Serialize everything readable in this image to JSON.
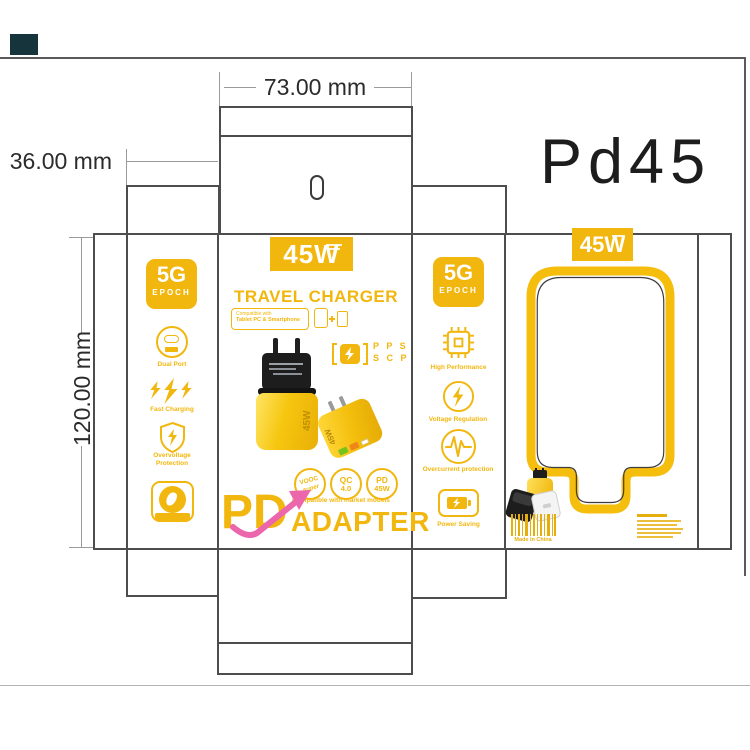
{
  "window": {
    "product_code": "Pd45"
  },
  "dimensions": {
    "width_label": "73.00 mm",
    "depth_label": "36.00 mm",
    "height_label": "120.00 mm"
  },
  "front": {
    "power_badge": "45W",
    "title": "TRAVEL CHARGER",
    "compat_line1": "Compatible with",
    "compat_line2": "Tablet PC & Smartphone",
    "pps_line1": "P P S",
    "pps_line2": "S C P",
    "eu_charger_label": "45W",
    "us_charger_label": "45W",
    "badge1_line1": "VOOC",
    "badge1_line2": "super",
    "badge2_line1": "QC",
    "badge2_line2": "4.0",
    "badge3_line1": "PD",
    "badge3_line2": "45W",
    "brand_pd": "PD",
    "brand_adapter": "ADAPTER",
    "brand_tagline": "Compatible with market models"
  },
  "left_side": {
    "badge_top": "5G",
    "badge_bottom": "EPOCH",
    "features": [
      {
        "icon": "dual-port-icon",
        "label": "Dual Port"
      },
      {
        "icon": "fast-charging-icon",
        "label": "Fast Charging"
      },
      {
        "icon": "overvoltage-shield-icon",
        "label": "Overvoltage Protection"
      },
      {
        "icon": "original-seal-icon",
        "label": "ORIGINAL"
      }
    ]
  },
  "right_side": {
    "badge_top": "5G",
    "badge_bottom": "EPOCH",
    "features": [
      {
        "icon": "chip-icon",
        "label": "High Performance"
      },
      {
        "icon": "voltage-regulation-icon",
        "label": "Voltage Regulation"
      },
      {
        "icon": "overcurrent-wave-icon",
        "label": "Overcurrent protection"
      },
      {
        "icon": "battery-saving-icon",
        "label": "Power Saving"
      }
    ]
  },
  "back": {
    "power_badge": "45W",
    "made_in": "Made in China"
  },
  "colors": {
    "brand_yellow": "#F2B70E",
    "accent_pink": "#EC66AC",
    "dieline_gray": "#4D4D4D"
  }
}
